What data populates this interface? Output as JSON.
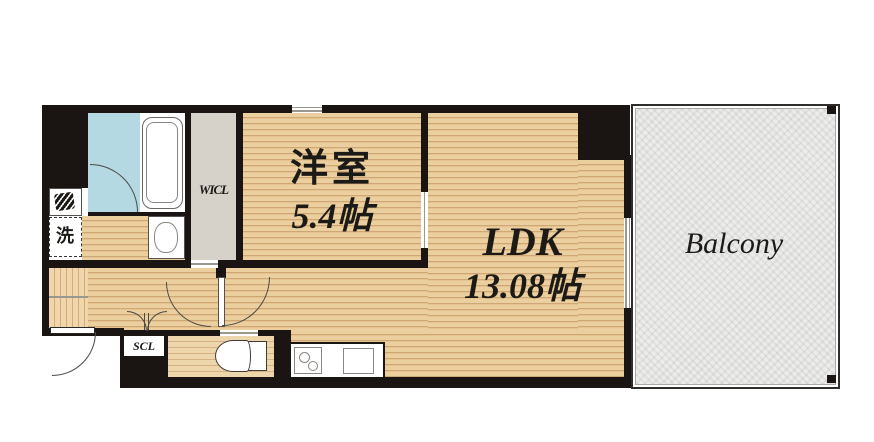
{
  "floorplan": {
    "rooms": {
      "western_room": {
        "name": "洋室",
        "area": "5.4帖"
      },
      "ldk": {
        "name": "LDK",
        "area": "13.08帖"
      },
      "balcony": {
        "name": "Balcony"
      },
      "walk_in_closet": {
        "abbr": "WICL"
      },
      "shoe_closet": {
        "abbr": "SCL"
      },
      "laundry": {
        "symbol": "洗"
      }
    },
    "icons": {
      "meter_box": "hatched-meter-box-icon",
      "stove": "two-burner-stove-icon",
      "sink": "kitchen-sink-icon",
      "toilet": "toilet-icon",
      "bathtub": "bathtub-icon",
      "washbasin": "washbasin-icon"
    },
    "colors": {
      "wall": "#1a1512",
      "wood_floor": "#e9c796",
      "wood_grain": "#cda876",
      "bathroom_floor": "#b4d9e2",
      "closet_floor": "#d6d2c9",
      "balcony_floor": "#ececea"
    }
  }
}
